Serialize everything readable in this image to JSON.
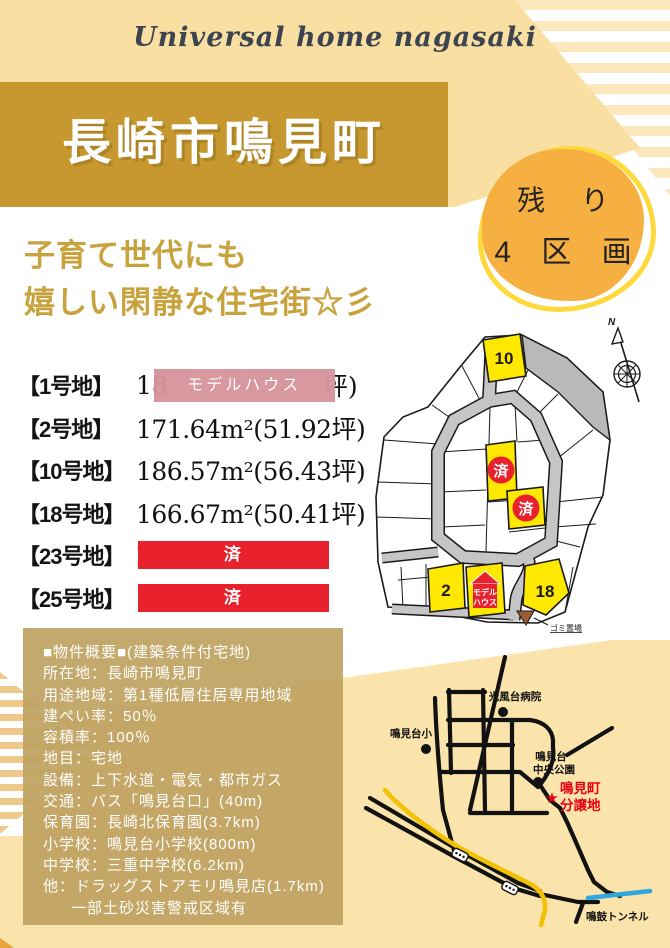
{
  "brand": {
    "logo_text": "Universal home nagasaki"
  },
  "header": {
    "title": "長崎市鳴見町",
    "badge": {
      "line1": "残 り",
      "line2": "4 区 画"
    },
    "tagline_line1": "子育て世代にも",
    "tagline_line2": "嬉しい閑静な住宅街☆彡"
  },
  "lots": [
    {
      "label": "【1号地】",
      "prefix": "18",
      "overlay": "モデルハウス",
      "suffix": "坪)"
    },
    {
      "label": "【2号地】",
      "value": "171.64m²(51.92坪)"
    },
    {
      "label": "【10号地】",
      "value": "186.57m²(56.43坪)"
    },
    {
      "label": "【18号地】",
      "value": "166.67m²(50.41坪)"
    },
    {
      "label": "【23号地】",
      "prefix": "2",
      "overlay": "済",
      "suffix": ")"
    },
    {
      "label": "【25号地】",
      "prefix": "1",
      "overlay": "済",
      "suffix": ")"
    }
  ],
  "site_map": {
    "lot10_label": "10",
    "lot2_label": "2",
    "lot18_label": "18",
    "sold_label_a": "済",
    "sold_label_b": "済",
    "model_house_line1": "モデル",
    "model_house_line2": "ハウス",
    "garbage_label": "ゴミ置場",
    "compass_label": "N"
  },
  "overview": {
    "lines": [
      "■物件概要■(建築条件付宅地)",
      "所在地：長崎市鳴見町",
      "用途地域：第1種低層住居専用地域",
      "建ぺい率：50％",
      "容積率：100％",
      "地目：宅地",
      "設備：上下水道・電気・都市ガス",
      "交通：バス「鳴見台口」(40m)",
      "保育園：長崎北保育園(3.7km)",
      "小学校：鳴見台小学校(800m)",
      "中学校：三重中学校(6.2km)",
      "他：ドラッグストアモリ鳴見店(1.7km)",
      "一部土砂災害警戒区域有"
    ]
  },
  "area_map": {
    "hospital_label": "光風台病院",
    "elementary_label": "鳴見台小",
    "park_label_line1": "鳴見台",
    "park_label_line2": "中央公園",
    "site_label_line1": "鳴見町",
    "site_label_line2": "分譲地",
    "site_star": "★",
    "tunnel_label": "鳴鼓トンネル"
  },
  "colors": {
    "cream": "#FADFA3",
    "banner_gold": "#C6982F",
    "badge_fill": "#F6B041",
    "badge_ring": "#FFD93B",
    "tagline_gold": "#C8A23C",
    "sold_red": "#E8212D",
    "model_pink": "#D5949B",
    "lot_yellow": "#FFE800",
    "road_gray": "#C5C5C5",
    "slope_gray": "#B9B9B9",
    "bottom_yellow": "#FBE4AC",
    "overview_tan": "#BFA361",
    "map_yellow_road": "#F3C104",
    "map_blue_road": "#2EA7E0",
    "map_red_text": "#E60012"
  }
}
